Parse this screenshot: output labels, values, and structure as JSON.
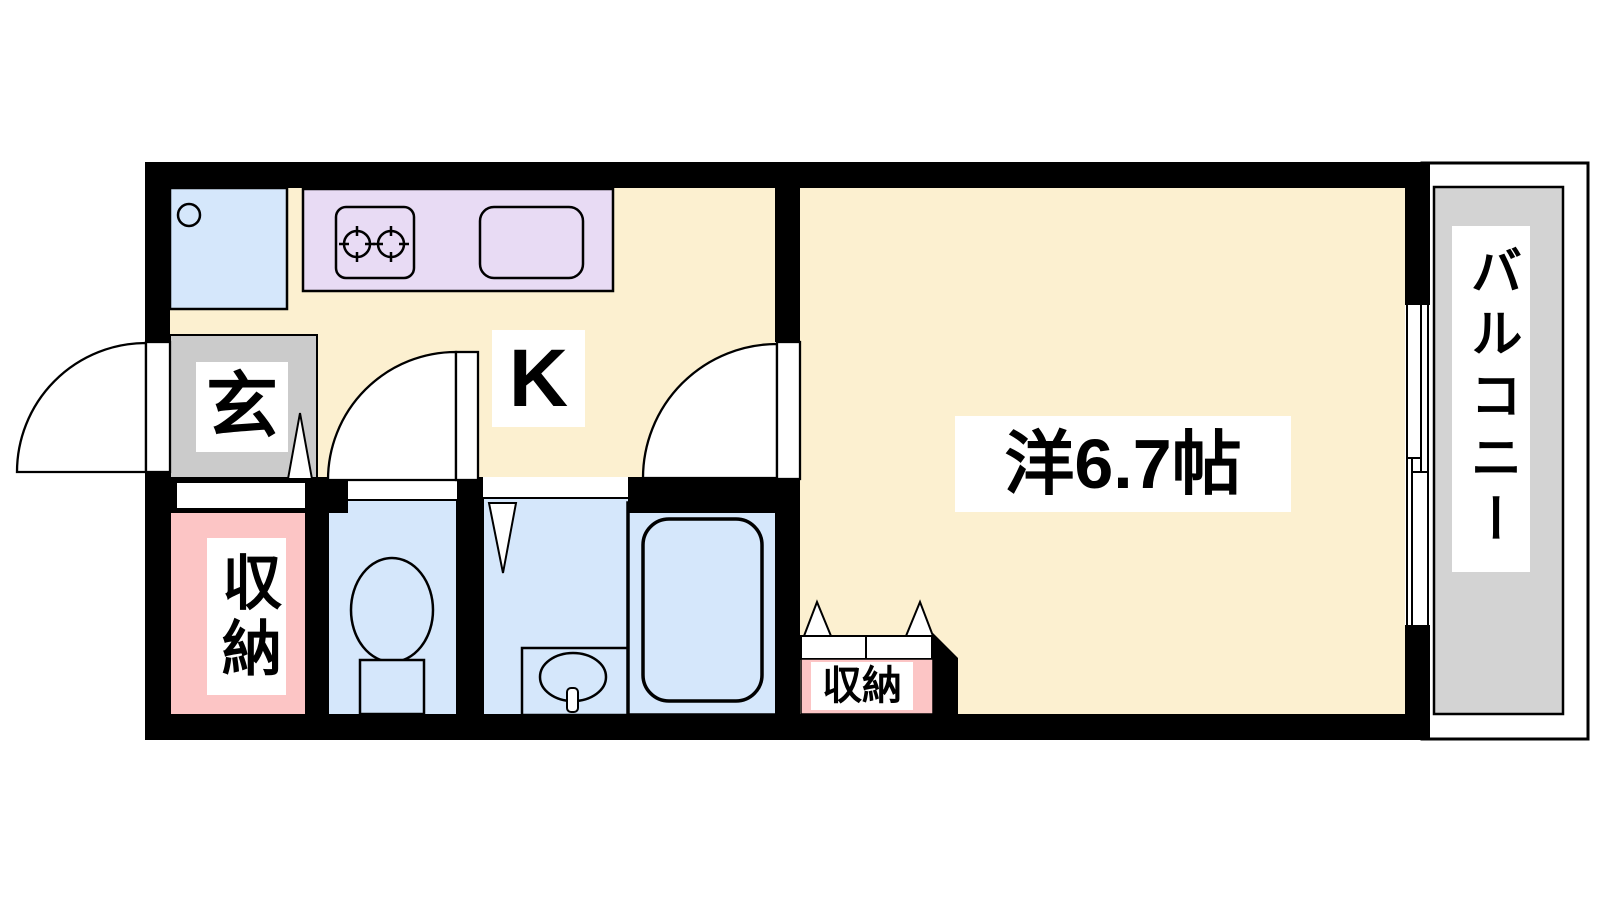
{
  "floorplan": {
    "type": "1K apartment floor plan",
    "labels": {
      "kitchen": "K",
      "entrance": "玄",
      "storage_left": "収納",
      "storage_main": "収納",
      "main_room": "洋6.7帖",
      "balcony": "バルコニー"
    },
    "fixtures": [
      "washing-machine-space",
      "gas-stove-2-burner",
      "kitchen-sink",
      "toilet",
      "washbasin",
      "bathtub",
      "sliding-window",
      "hinged-doors",
      "folding-doors"
    ],
    "colors": {
      "floor_cream": "#FCF0D0",
      "kitchen_counter_lavender": "#E8DBF4",
      "water_area_blue": "#D5E7FB",
      "entrance_gray": "#CBCBCB",
      "balcony_gray": "#D3D3D3",
      "storage_pink": "#FCC5C5",
      "wall_black": "#000000"
    }
  }
}
